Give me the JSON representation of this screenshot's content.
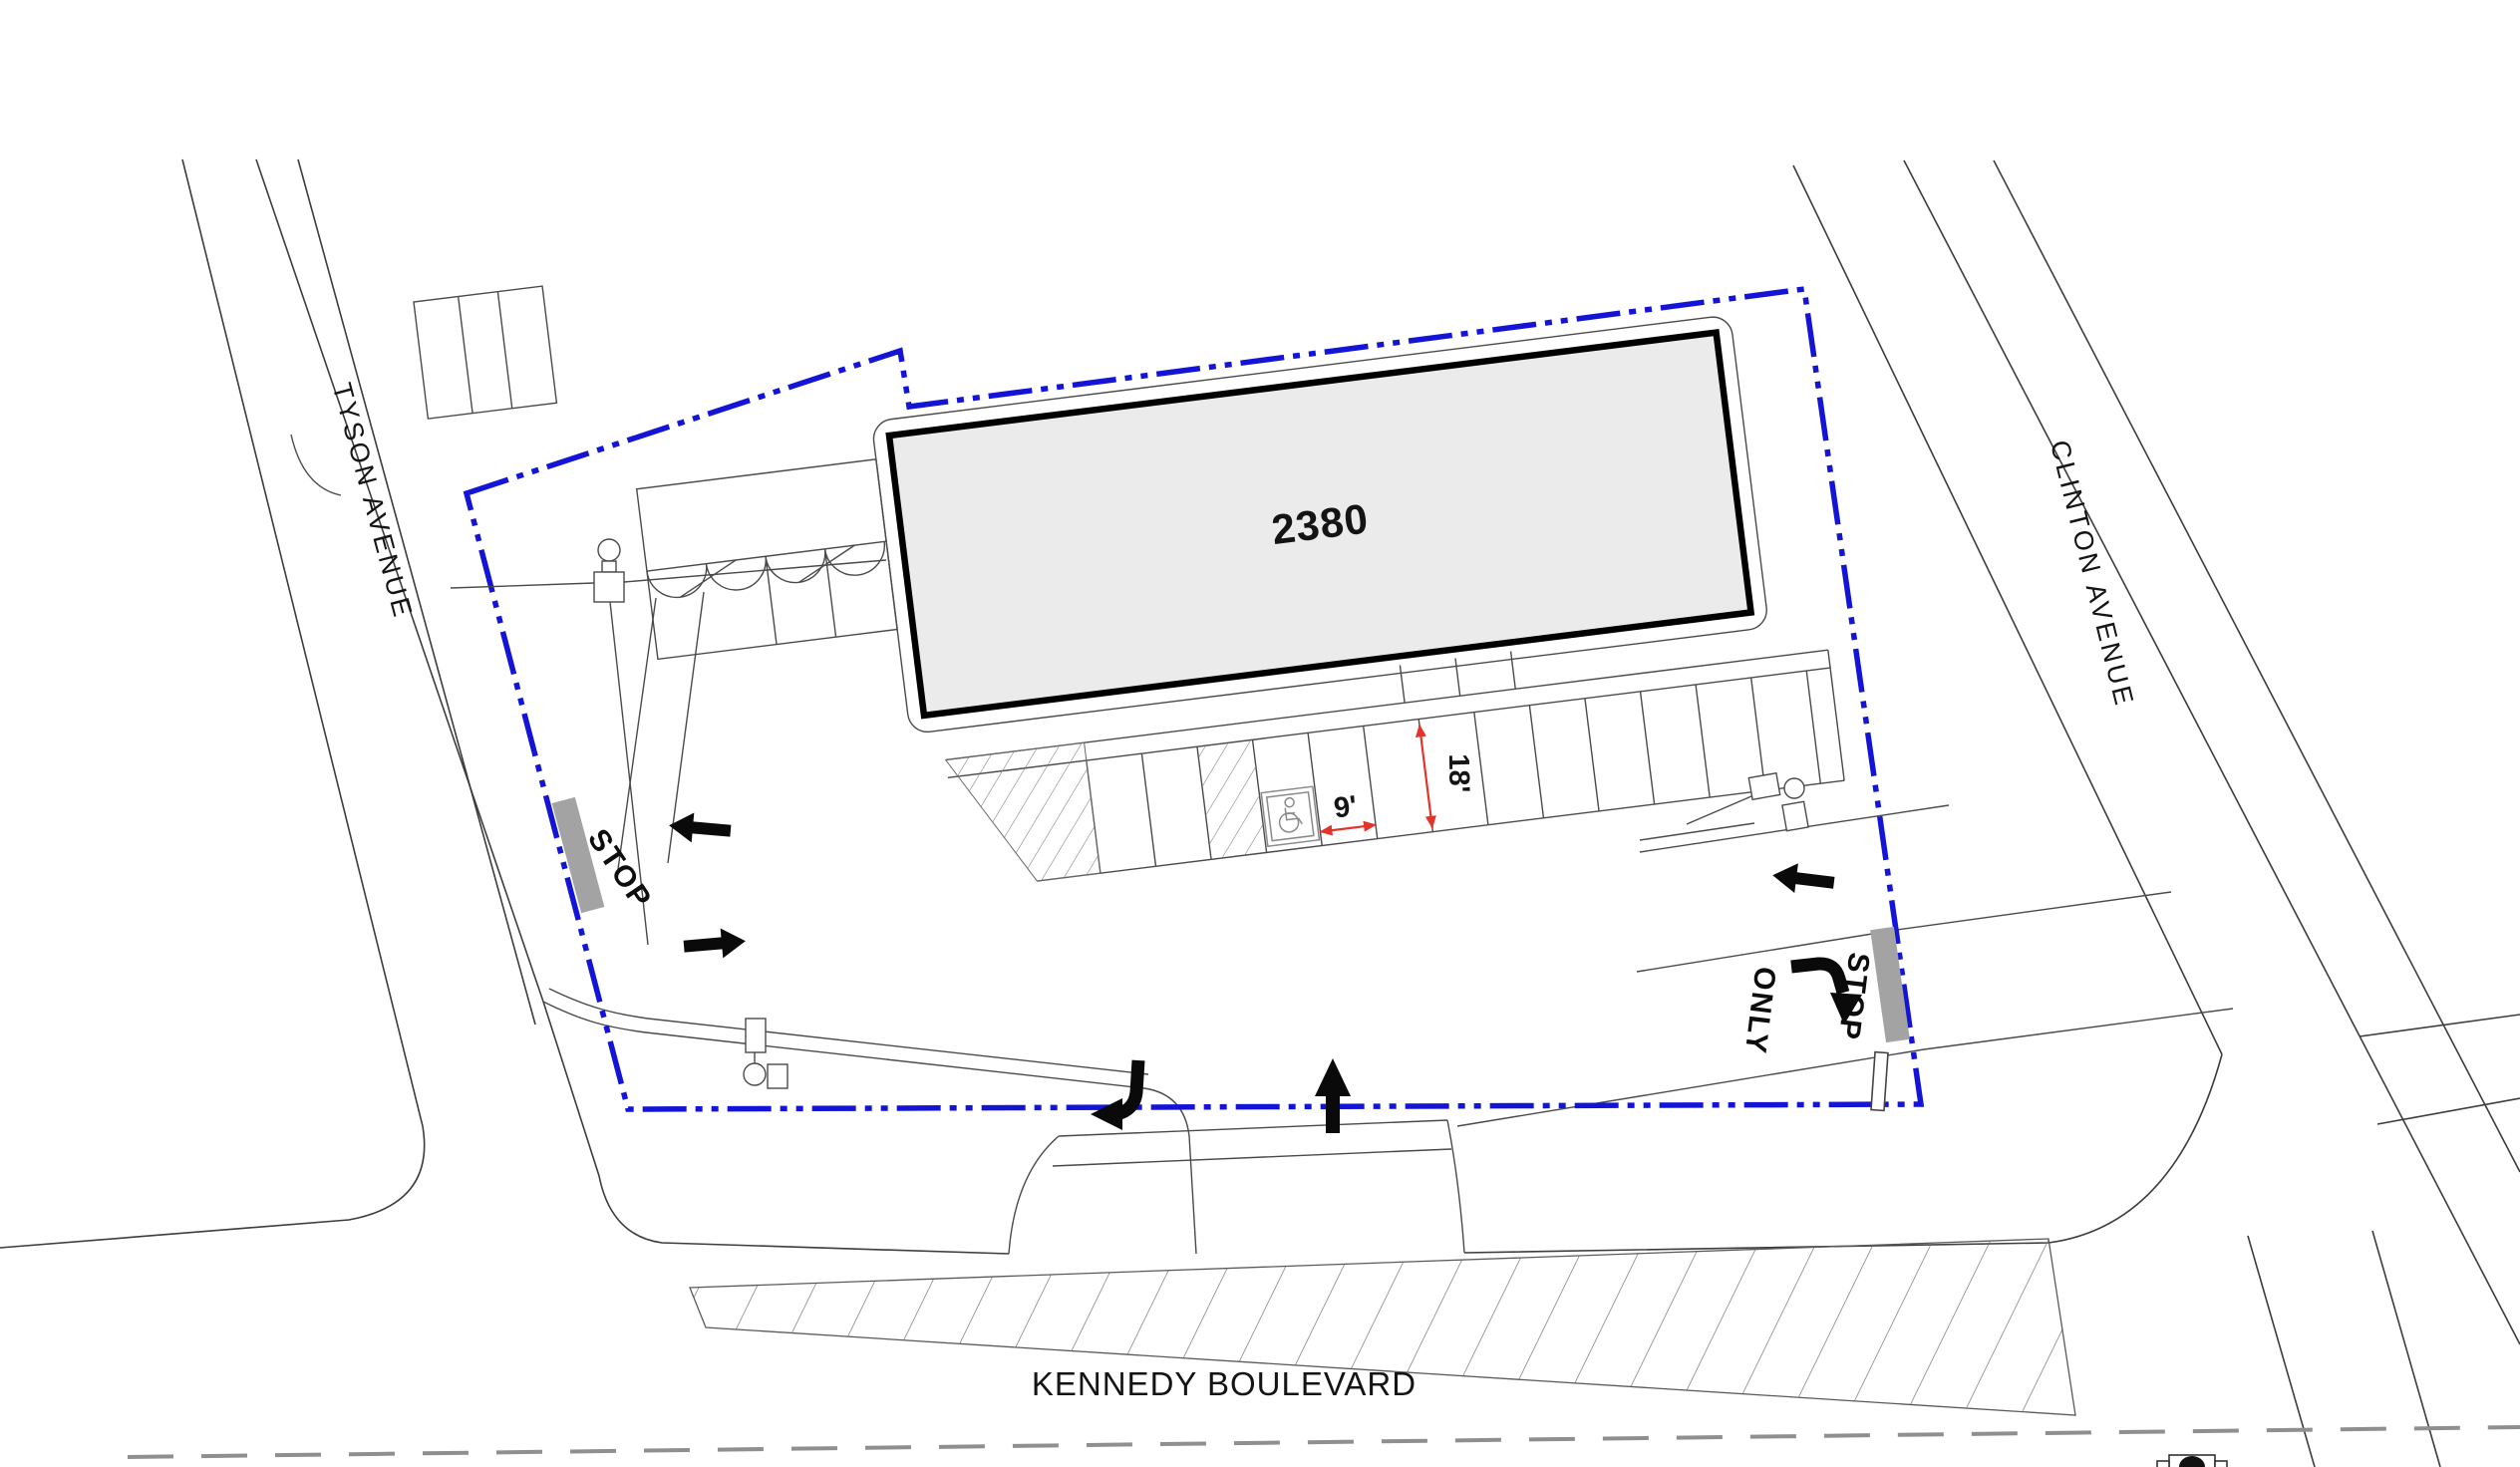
{
  "plan": {
    "streets": {
      "tyson_label": "TYSON AVENUE",
      "clinton_label": "CLINTON AVENUE",
      "kennedy_label": "KENNEDY BOULEVARD"
    },
    "building": {
      "number_label": "2380",
      "fill": "#ebebeb"
    },
    "markings": {
      "stop_west_label": "STOP",
      "stop_east_label": "STOP",
      "only_label": "ONLY"
    },
    "dimensions": {
      "stall_width_label": "9'",
      "stall_depth_label": "18'"
    },
    "colors": {
      "property_line": "#1414d6",
      "dimension_red": "#e43329",
      "stop_bar_gray": "#a3a3a3",
      "line_dark": "#3d3d3d",
      "centerline_gray": "#8f8f8f"
    }
  }
}
